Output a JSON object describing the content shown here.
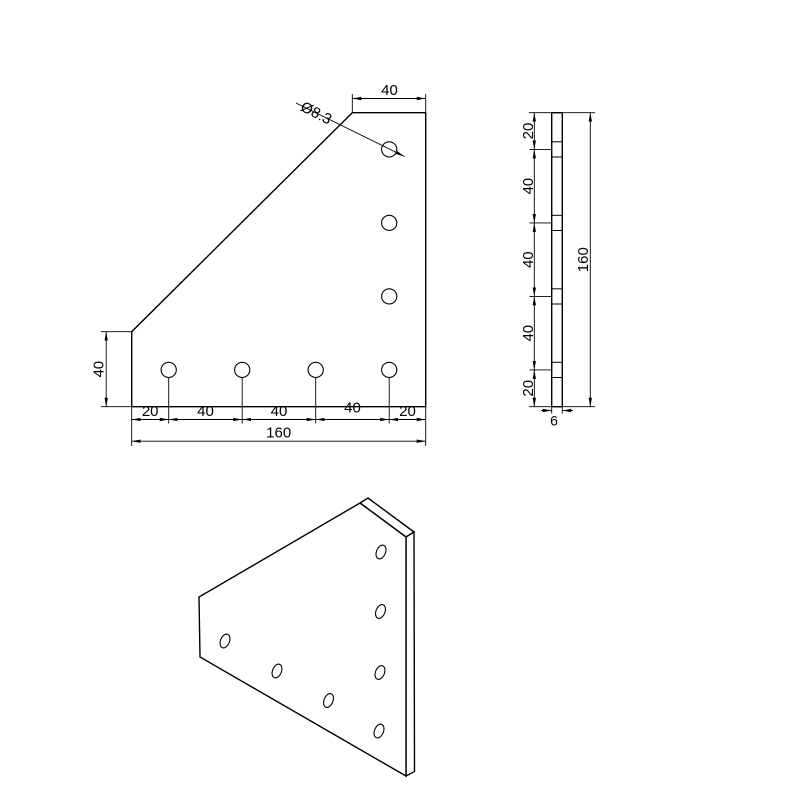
{
  "colors": {
    "line": "#000000",
    "background": "#ffffff"
  },
  "front_view": {
    "top_width": "40",
    "hole_diameter": "Ø8.3",
    "left_height": "40",
    "bottom_chain": [
      "20",
      "40",
      "40",
      "40",
      "20"
    ],
    "total_width": "160"
  },
  "side_view": {
    "chain": [
      "20",
      "40",
      "40",
      "40",
      "20"
    ],
    "total_height": "160",
    "thickness": "6"
  }
}
